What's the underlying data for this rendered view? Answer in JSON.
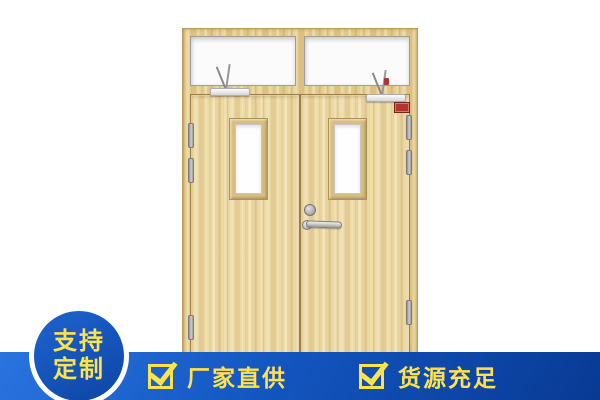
{
  "page": {
    "type": "product-promo-image",
    "background_color": "#ffffff"
  },
  "door_graphic": {
    "description": "Light wood double fire door with glazed transom, two vision panels, door closers, hinges, lever handle and red fire-rating label",
    "wood_color": "#ead59c",
    "frame_color": "#e3c787",
    "glass_color": "#fbfbfb",
    "hardware_color": "#c0c0c0",
    "fire_label_color": "#b5342e"
  },
  "badge": {
    "line1": "支持",
    "line2": "定制",
    "background_color": "#1253b4",
    "ring_color": "#ffffff",
    "text_color": "#ffe34d"
  },
  "banner": {
    "background_start": "#2a74e0",
    "background_end": "#083a94",
    "text_color": "#ffe34d",
    "items": [
      {
        "icon": "checkbox-checked-icon",
        "label": "厂家直供"
      },
      {
        "icon": "checkbox-checked-icon",
        "label": "货源充足"
      }
    ]
  }
}
